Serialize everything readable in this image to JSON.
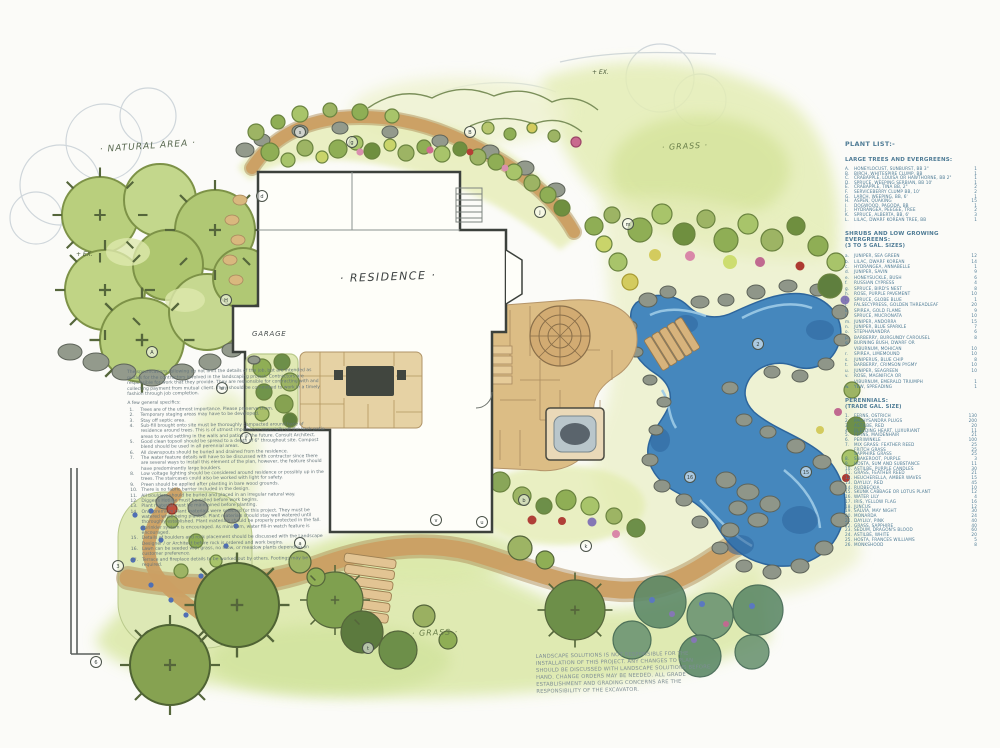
{
  "plan": {
    "labels": {
      "natural_area": "· NATURAL AREA ·",
      "residence": "· RESIDENCE ·",
      "garage": "GARAGE",
      "grass_top": "· GRASS ·",
      "grass_bottom": "· GRASS ·",
      "existing_tree_1": "+ EX.",
      "existing_tree_2": "+ EX."
    },
    "colors": {
      "water": "#4587bd",
      "foliage": "#8fae55",
      "path": "#c6965a",
      "list_text": "#4e7b95"
    },
    "callouts": [
      {
        "label": "A",
        "x": 152,
        "y": 352
      },
      {
        "label": "H",
        "x": 226,
        "y": 300
      },
      {
        "label": "d",
        "x": 262,
        "y": 196
      },
      {
        "label": "s",
        "x": 300,
        "y": 132
      },
      {
        "label": "g",
        "x": 352,
        "y": 142
      },
      {
        "label": "B",
        "x": 470,
        "y": 132
      },
      {
        "label": "j",
        "x": 540,
        "y": 212
      },
      {
        "label": "m",
        "x": 628,
        "y": 224
      },
      {
        "label": "w",
        "x": 222,
        "y": 388
      },
      {
        "label": "f",
        "x": 246,
        "y": 438
      },
      {
        "label": "v",
        "x": 436,
        "y": 520
      },
      {
        "label": "u",
        "x": 482,
        "y": 522
      },
      {
        "label": "b",
        "x": 524,
        "y": 500
      },
      {
        "label": "k",
        "x": 586,
        "y": 546
      },
      {
        "label": "a",
        "x": 300,
        "y": 543
      },
      {
        "label": "t",
        "x": 368,
        "y": 648
      },
      {
        "label": "2",
        "x": 758,
        "y": 344
      },
      {
        "label": "16",
        "x": 690,
        "y": 477
      },
      {
        "label": "15",
        "x": 806,
        "y": 472
      },
      {
        "label": "3",
        "x": 118,
        "y": 566
      },
      {
        "label": "6",
        "x": 96,
        "y": 662
      }
    ]
  },
  "notes": {
    "intro": "The specifications following do not limit the details of the job, but are intended as guides for the contractors involved in the landscaping project. Contractors are responsible for work that they provide. They are responsible for contracting with and collecting payment from mutual client. They should be committed to work in a timely fashion through job completion.",
    "list_title": "A few general specifics:",
    "items": [
      {
        "num": "1.",
        "text": "Trees are of the utmost importance. Please preserve them."
      },
      {
        "num": "2.",
        "text": "Temporary staging areas may have to be developed."
      },
      {
        "num": "3.",
        "text": "Stay off septic area."
      },
      {
        "num": "4.",
        "text": "Sub-fill brought onto site must be thoroughly compacted around base of residence around trees. This is of utmost importance especially off the back patio areas to avoid settling in the walls and patios in the future. Consult Architect."
      },
      {
        "num": "5.",
        "text": "Good clean topsoil should be spread to a depth of 6\" throughout site. Compost blend should be used in all perennial areas."
      },
      {
        "num": "6.",
        "text": "All downspouts should be buried and drained from the residence."
      },
      {
        "num": "7.",
        "text": "The water feature details will have to be discussed with contractor since there are several ways to install this element of the plan, however, the feature should have predominantly large boulders."
      },
      {
        "num": "8.",
        "text": "Low voltage lighting should be considered around residence or possibly up in the trees. The staircases could also be worked with light for safety."
      },
      {
        "num": "9.",
        "text": "Preen should be applied after planting in bare wood grounds."
      },
      {
        "num": "10.",
        "text": "There is no fabric barrier included in the design."
      },
      {
        "num": "11.",
        "text": "All boulders should be buried and placed in an irregular natural way."
      },
      {
        "num": "12.",
        "text": "Digger's Hotline must be called before work begins."
      },
      {
        "num": "13.",
        "text": "Plant material must be maintained before planting."
      },
      {
        "num": "14.",
        "text": "Only premium plant materials were selected for this project. They must be watered while being planted. Plant materials should stay well watered until thoroughly established. Plant materials should be properly protected in the fall. Sprinkler system is encouraged. As minimum, water fill-in watch feature is encouraged."
      },
      {
        "num": "15.",
        "text": "Details of boulders and rock placement should be discussed with the Landscape Designer / or Architect before rock is ordered and work begins."
      },
      {
        "num": "16.",
        "text": "Lawn can be seeded with grass, no mow, or meadow plants depending on customer preference."
      },
      {
        "num": "17.",
        "text": "Terrace and fireplace details to be worked out by others. Footings may be required."
      }
    ]
  },
  "plant_list": {
    "title": "PLANT LIST:-",
    "sections": [
      {
        "heading": "LARGE TREES AND EVERGREENS:",
        "subheading": "",
        "items": [
          {
            "key": "A.",
            "label": "HONEYLOCUST, SUNBURST, BB 3\"",
            "qty": "1"
          },
          {
            "key": "B.",
            "label": "BIRCH, WHITESPIRE CLUMP, BB",
            "qty": "1"
          },
          {
            "key": "C.",
            "label": "CRABAPPLE, LOUISA OR HAWTHORNE, BB 2\"",
            "qty": "1"
          },
          {
            "key": "D.",
            "label": "SPRUCE, WEEPING SERBIAN, BB 10'",
            "qty": "1"
          },
          {
            "key": "E.",
            "label": "CRABAPPLE, TINA BB, 2\"",
            "qty": "2"
          },
          {
            "key": "F.",
            "label": "SERVICEBERRY CLUMP BB, 10'",
            "qty": "2"
          },
          {
            "key": "G.",
            "label": "LARCH, WEEPING, BB, 6'",
            "qty": "1"
          },
          {
            "key": "H.",
            "label": "ASPEN, QUAKING",
            "qty": "15"
          },
          {
            "key": "I.",
            "label": "DOGWOOD, PAGODA, BB",
            "qty": "1"
          },
          {
            "key": "J.",
            "label": "HYDRANGEA, PEEGEE, TREE",
            "qty": "2"
          },
          {
            "key": "K.",
            "label": "SPRUCE, ALBERTA, BB, 6'",
            "qty": "3"
          },
          {
            "key": "L.",
            "label": "LILAC, DWARF KOREAN TREE, BB",
            "qty": "1"
          }
        ]
      },
      {
        "heading": "SHRUBS AND LOW GROWING EVERGREENS:",
        "subheading": "(3 TO 5 GAL. SIZES)",
        "items": [
          {
            "key": "a.",
            "label": "JUNIPER, SEA GREEN",
            "qty": "12"
          },
          {
            "key": "b.",
            "label": "LILAC, DWARF KOREAN",
            "qty": "14"
          },
          {
            "key": "c.",
            "label": "HYDRANGEA, ANNABELLE",
            "qty": "1"
          },
          {
            "key": "d.",
            "label": "JUNIPER, SAVIN",
            "qty": "9"
          },
          {
            "key": "e.",
            "label": "HONEYSUCKLE, BUSH",
            "qty": "6"
          },
          {
            "key": "f.",
            "label": "RUSSIAN CYPRESS",
            "qty": "4"
          },
          {
            "key": "g.",
            "label": "SPRUCE, BIRD'S NEST",
            "qty": "8"
          },
          {
            "key": "h.",
            "label": "ROSE, PURPLE PAVEMENT",
            "qty": "10"
          },
          {
            "key": "i.",
            "label": "SPRUCE, GLOBE BLUE",
            "qty": "1"
          },
          {
            "key": "j.",
            "label": "FALSECYPRESS, GOLDEN THREADLEAF",
            "qty": "20"
          },
          {
            "key": "k.",
            "label": "SPIREA, GOLD FLAME",
            "qty": "9"
          },
          {
            "key": "l.",
            "label": "SPRUCE, MUCRONATA",
            "qty": "10"
          },
          {
            "key": "m.",
            "label": "JUNIPER, ANDORRA",
            "qty": "15"
          },
          {
            "key": "n.",
            "label": "JUNIPER, BLUE SPARKLE",
            "qty": "7"
          },
          {
            "key": "o.",
            "label": "STEPHANANDRA",
            "qty": "6"
          },
          {
            "key": "p.",
            "label": "BARBERRY, BURGUNDY CAROUSEL",
            "qty": "8"
          },
          {
            "key": "q.",
            "label": "BURNING BUSH, DWARF OR",
            "qty": ""
          },
          {
            "key": "",
            "label": "VIBURNUM, MOHICAN",
            "qty": "10"
          },
          {
            "key": "r.",
            "label": "SPIREA, LIMEMOUND",
            "qty": "10"
          },
          {
            "key": "s.",
            "label": "JUNIPERUS, BLUE CHIP",
            "qty": "8"
          },
          {
            "key": "t.",
            "label": "BARBERRY, CRIMSON PYGMY",
            "qty": "10"
          },
          {
            "key": "u.",
            "label": "JUNIPER, SEAGREEN",
            "qty": "10"
          },
          {
            "key": "v.",
            "label": "ROSE, MAGNIFICA OR",
            "qty": ""
          },
          {
            "key": "",
            "label": "VIBURNUM, EMERALD TRIUMPH",
            "qty": "1"
          },
          {
            "key": "w.",
            "label": "YEW, SPREADING",
            "qty": "1"
          }
        ]
      },
      {
        "heading": "PERENNIALS:",
        "subheading": "(TRADE GAL. SIZE)",
        "items": [
          {
            "key": "1.",
            "label": "FERNS, OSTRICH",
            "qty": "130"
          },
          {
            "key": "2.",
            "label": "PACHYSANDRA PLUGS",
            "qty": "200"
          },
          {
            "key": "3.",
            "label": "ASTILBE, RED",
            "qty": "20"
          },
          {
            "key": "4.",
            "label": "BLEEDING HEART, LUXURIANT",
            "qty": "11"
          },
          {
            "key": "5.",
            "label": "FERNS, MAIDENHAIR",
            "qty": "21"
          },
          {
            "key": "6.",
            "label": "PERIWINKLE",
            "qty": "100"
          },
          {
            "key": "7.",
            "label": "MIX GRASS:  FEATHER REED",
            "qty": "25"
          },
          {
            "key": "",
            "label": "FRITCH GRASS",
            "qty": "25"
          },
          {
            "key": "",
            "label": "SAPPHIRE GRASS",
            "qty": "25"
          },
          {
            "key": "8.",
            "label": "SNAKEROOT, PURPLE",
            "qty": "3"
          },
          {
            "key": "9.",
            "label": "HOSTA, SUM AND SUBSTANCE",
            "qty": "11"
          },
          {
            "key": "10.",
            "label": "ASTILBE, PURPLE CANDLES",
            "qty": "30"
          },
          {
            "key": "11.",
            "label": "GRASS, FEATHER REED",
            "qty": "21"
          },
          {
            "key": "12.",
            "label": "HEUCHERELLA, AMBER WAVES",
            "qty": "15"
          },
          {
            "key": "13.",
            "label": "DAYLILY, RED",
            "qty": "45"
          },
          {
            "key": "14.",
            "label": "RUDBECKIA",
            "qty": "10"
          },
          {
            "key": "15.",
            "label": "SKUNK CABBAGE OR LOTUS PLANT",
            "qty": "12"
          },
          {
            "key": "16.",
            "label": "WATER LILY",
            "qty": "4"
          },
          {
            "key": "17.",
            "label": "IRIS, YELLOW FLAG",
            "qty": "16"
          },
          {
            "key": "18.",
            "label": "JUNCUS",
            "qty": "12"
          },
          {
            "key": "19.",
            "label": "SALVIA, MAY NIGHT",
            "qty": "30"
          },
          {
            "key": "20.",
            "label": "MONARDA",
            "qty": "24"
          },
          {
            "key": "21.",
            "label": "DAYLILY, PINK",
            "qty": "40"
          },
          {
            "key": "22.",
            "label": "GRASS, SAPPHIRE",
            "qty": "40"
          },
          {
            "key": "23.",
            "label": "SEDUM, DRAGON'S BLOOD",
            "qty": "60"
          },
          {
            "key": "24.",
            "label": "ASTILBE, WHITE",
            "qty": "20"
          },
          {
            "key": "25.",
            "label": "HOSTA, FRANCES WILLIAMS",
            "qty": "5"
          },
          {
            "key": "26.",
            "label": "MONKSHOOD",
            "qty": "8"
          }
        ]
      }
    ]
  },
  "disclaimer": "LANDSCAPE SOLUTIONS IS NOT RESPONSIBLE FOR THE INSTALLATION OF THIS PROJECT.  ANY CHANGES TO PLAN SHOULD BE DISCUSSED WITH LANDSCAPE SOLUTIONS BEFORE HAND. CHANGE ORDERS MAY BE NEEDED.  ALL GRADE ESTABLISHMENT AND GRADING CONCERNS ARE THE RESPONSIBILITY OF THE EXCAVATOR."
}
